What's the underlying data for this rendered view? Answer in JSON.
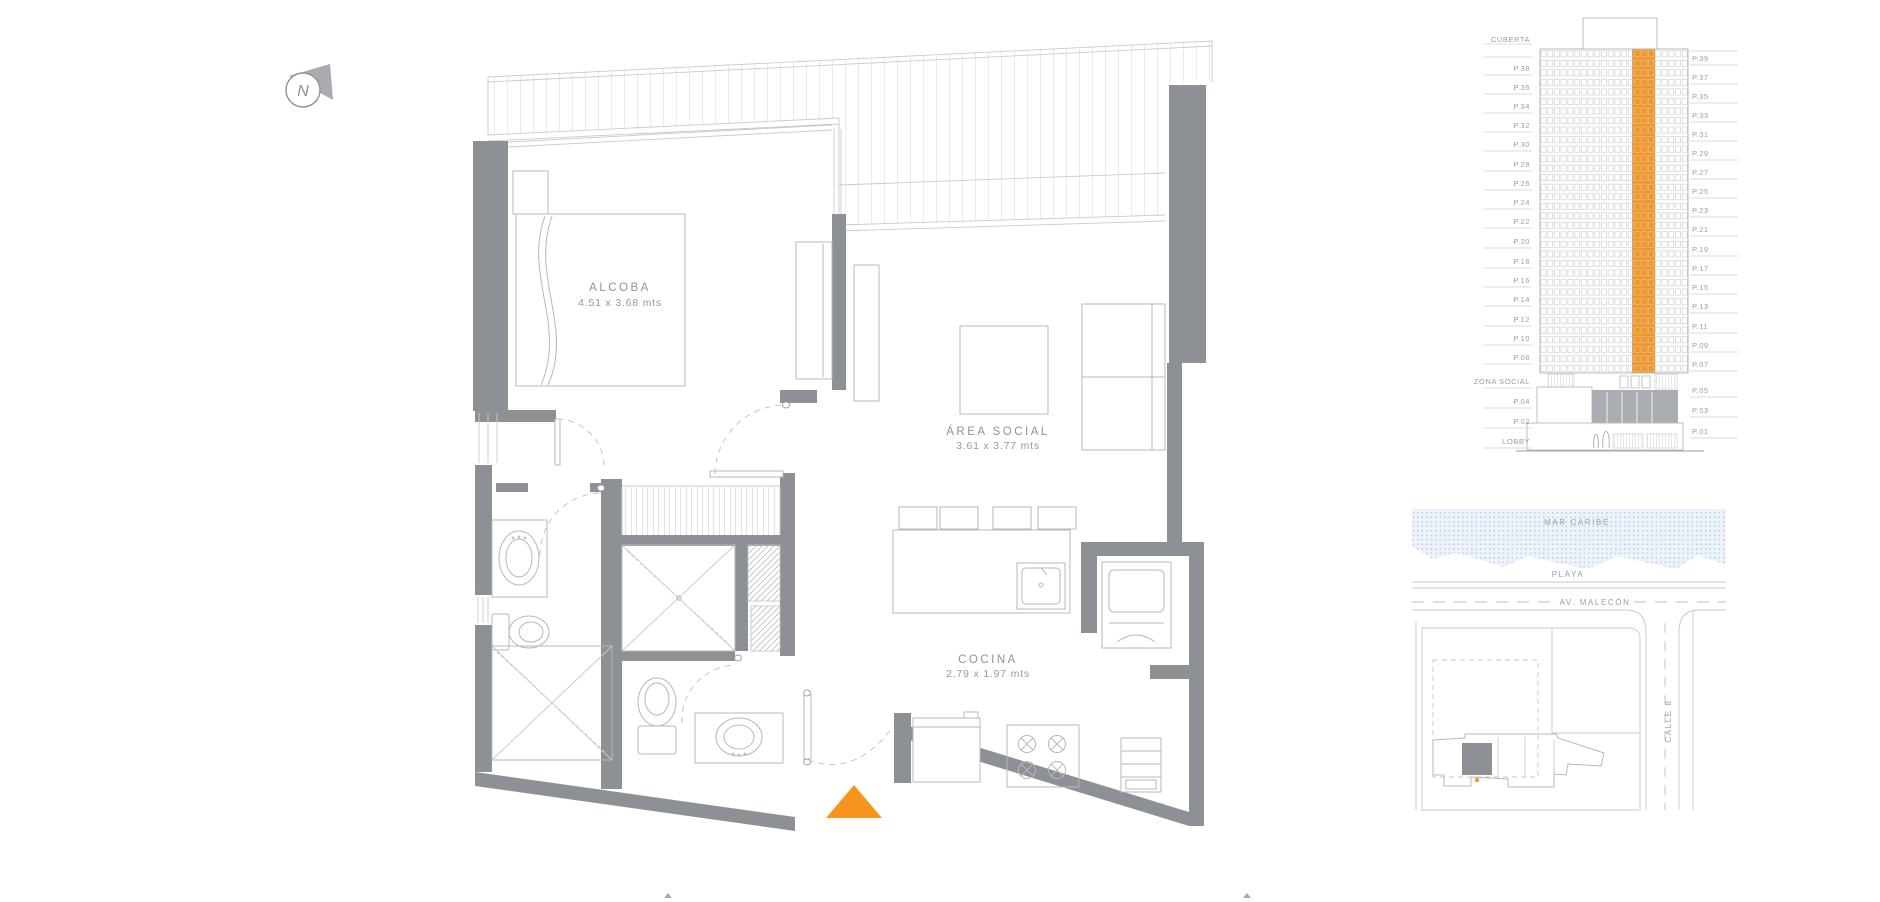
{
  "compass": {
    "label": "N"
  },
  "floor_plan": {
    "rooms": [
      {
        "id": "alcoba",
        "name": "ALCOBA",
        "dimensions": "4.51 x 3.68 mts"
      },
      {
        "id": "area_social",
        "name": "ÁREA SOCIAL",
        "dimensions": "3.61 x 3.77 mts"
      },
      {
        "id": "cocina",
        "name": "COCINA",
        "dimensions": "2.79 x 1.97 mts"
      }
    ],
    "entrance_marker_color": "#F7941E"
  },
  "elevation": {
    "left_labels": [
      "CUBERTA",
      "P.38",
      "P.36",
      "P.34",
      "P.32",
      "P.30",
      "P.28",
      "P.26",
      "P.24",
      "P.22",
      "P.20",
      "P.18",
      "P.16",
      "P.14",
      "P.12",
      "P.10",
      "P.08",
      "ZONA SOCIAL",
      "P.04",
      "P.02",
      "LOBBY"
    ],
    "right_labels": [
      "P.39",
      "P.37",
      "P.35",
      "P.33",
      "P.31",
      "P.29",
      "P.27",
      "P.25",
      "P.23",
      "P.21",
      "P.19",
      "P.17",
      "P.15",
      "P.13",
      "P.11",
      "P.09",
      "P.07",
      "P.05",
      "P.03",
      "P.01"
    ],
    "highlight_color": "#F7941E"
  },
  "map": {
    "sea_label": "MAR CARIBE",
    "beach_label": "PLAYA",
    "avenue_label": "AV. MALECÓN",
    "street_label": "CALLE 8"
  },
  "colors": {
    "accent_orange": "#F7941E",
    "wall_gray": "#8D9196",
    "water_blue": "#BCD0E8"
  }
}
